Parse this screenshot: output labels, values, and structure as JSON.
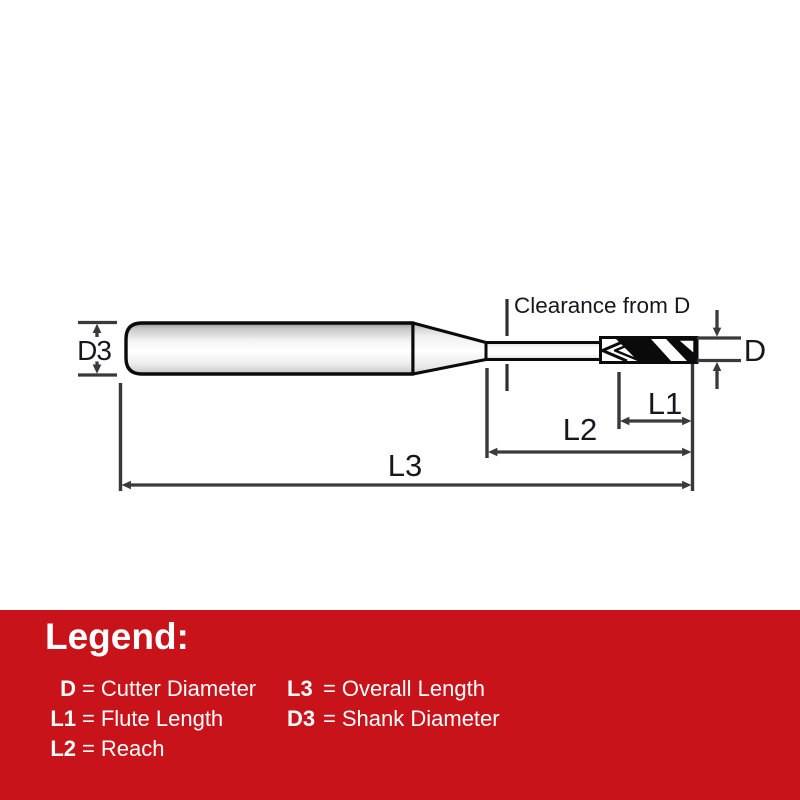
{
  "diagram": {
    "clearance_label": "Clearance from D",
    "dim_d3": "D3",
    "dim_d": "D",
    "dim_l1": "L1",
    "dim_l2": "L2",
    "dim_l3": "L3"
  },
  "legend": {
    "title": "Legend:",
    "eq": "=",
    "left": [
      {
        "code": "D",
        "desc": "Cutter Diameter"
      },
      {
        "code": "L1",
        "desc": "Flute Length"
      },
      {
        "code": "L2",
        "desc": "Reach"
      }
    ],
    "right": [
      {
        "code": "L3",
        "desc": "Overall Length"
      },
      {
        "code": "D3",
        "desc": "Shank Diameter"
      }
    ]
  },
  "colors": {
    "legend_background": "#C8131A",
    "legend_text": "#FFFFFF",
    "drawing_outline": "#0B0B0B",
    "dimension_lines": "#3A3A3E",
    "dimension_text": "#17171F",
    "page_background": "#FFFFFF"
  }
}
